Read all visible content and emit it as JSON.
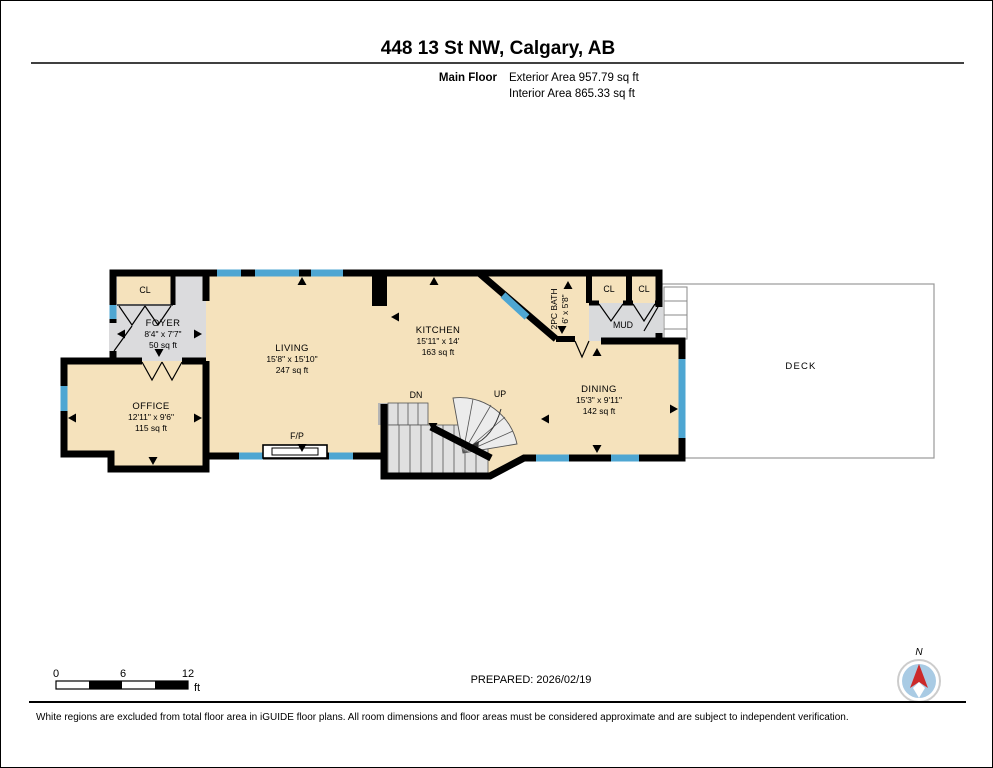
{
  "header": {
    "title": "448 13 St NW, Calgary, AB",
    "floor_label": "Main Floor",
    "exterior_area": "Exterior Area 957.79 sq ft",
    "interior_area": "Interior Area 865.33 sq ft"
  },
  "rooms": {
    "foyer": {
      "name": "FOYER",
      "dims": "8'4\" x 7'7\"",
      "area": "50 sq ft"
    },
    "office": {
      "name": "OFFICE",
      "dims": "12'11\" x 9'6\"",
      "area": "115 sq ft"
    },
    "living": {
      "name": "LIVING",
      "dims": "15'8\" x 15'10\"",
      "area": "247 sq ft"
    },
    "kitchen": {
      "name": "KITCHEN",
      "dims": "15'11\" x 14'",
      "area": "163 sq ft"
    },
    "dining": {
      "name": "DINING",
      "dims": "15'3\" x 9'11\"",
      "area": "142 sq ft"
    },
    "bath": {
      "name": "2PC BATH",
      "dims": "6' x 5'8\""
    },
    "mud": {
      "name": "MUD"
    },
    "closet_foyer": "CL",
    "closet_left": "CL",
    "closet_right": "CL",
    "deck": "DECK",
    "fireplace": "F/P",
    "stairs_down": "DN",
    "stairs_up": "UP"
  },
  "scale_bar": {
    "t0": "0",
    "t6": "6",
    "t12": "12",
    "unit": "ft"
  },
  "prepared": "PREPARED: 2026/02/19",
  "compass": {
    "label": "N"
  },
  "footer": {
    "disclaimer": "White regions are excluded from total floor area in iGUIDE floor plans. All room dimensions and floor areas must be considered approximate and are subject to independent verification."
  },
  "colors": {
    "wall": "#000000",
    "floor_beige": "#F5E2BC",
    "floor_gray": "#DBDBDD",
    "stair_gray": "#E0E0E0",
    "window_blue": "#4EA6D2",
    "compass_fill": "#A9CBE4",
    "compass_needle": "#CC2A2A"
  }
}
